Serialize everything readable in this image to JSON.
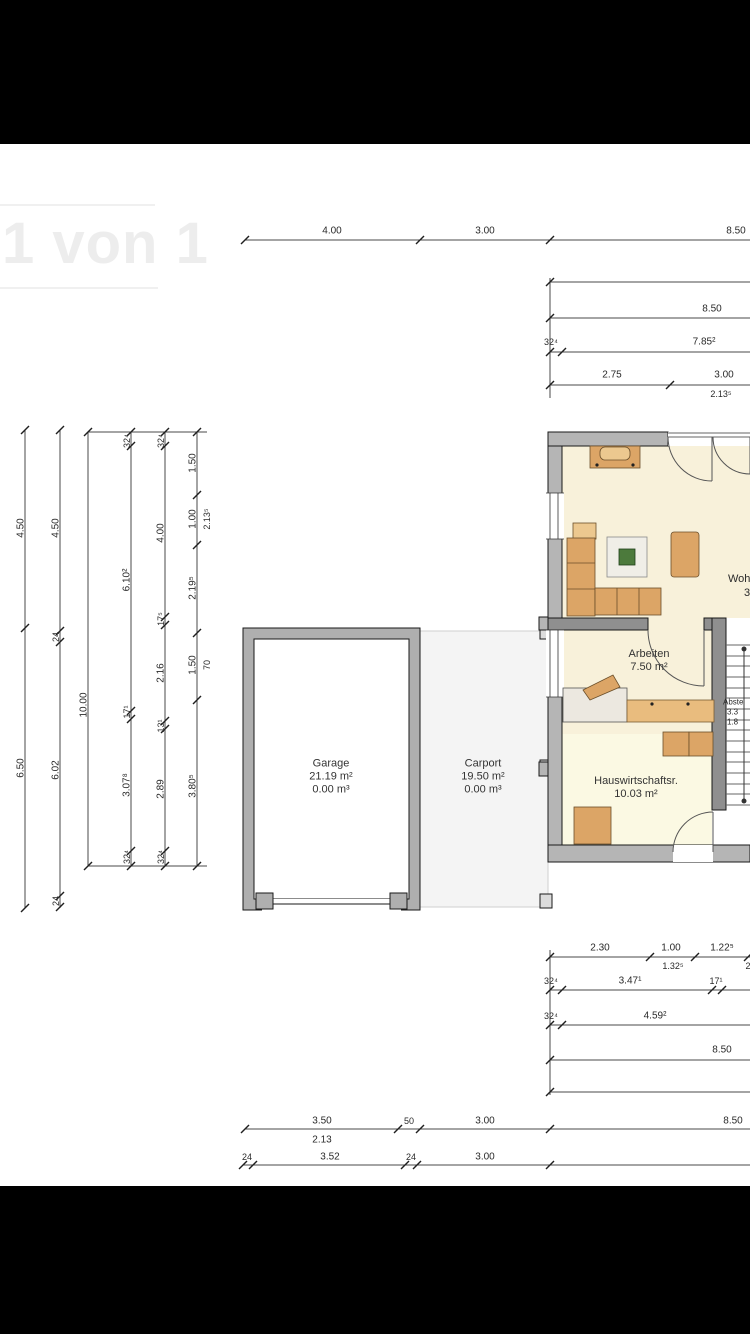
{
  "viewer": {
    "watermark": "1 von 1"
  },
  "colors": {
    "wall": "#B5B5B5",
    "innerwall": "#8F8F8F",
    "cream": "#F8F1DA",
    "pale": "#FBF9E3",
    "tan": "#DCA566",
    "tanlight": "#ECC88F",
    "counter": "#E9BC7E",
    "carport": "#F4F4F4",
    "dimline": "#4a4a4a",
    "dimtext": "#2a2a2a",
    "plant": "#4C7A3C"
  },
  "rooms": [
    {
      "name": "garage",
      "x": 331,
      "y": 777,
      "lines": [
        "Garage",
        "21.19 m²",
        "0.00 m³"
      ]
    },
    {
      "name": "carport",
      "x": 483,
      "y": 777,
      "lines": [
        "Carport",
        "19.50 m²",
        "0.00 m³"
      ]
    },
    {
      "name": "arbeiten",
      "x": 649,
      "y": 661,
      "lines": [
        "Arbeiten",
        "7.50 m²"
      ]
    },
    {
      "name": "hauswirtschaftsraum",
      "x": 636,
      "y": 788,
      "lines": [
        "Hauswirtschaftsr.",
        "10.03 m²"
      ]
    }
  ],
  "labels": [
    {
      "t": "4.00",
      "x": 332,
      "y": 231
    },
    {
      "t": "3.00",
      "x": 485,
      "y": 231
    },
    {
      "t": "8.50",
      "x": 736,
      "y": 231
    },
    {
      "t": "8.50",
      "x": 712,
      "y": 309
    },
    {
      "t": "32⁴",
      "x": 551,
      "y": 342,
      "s": 9
    },
    {
      "t": "7.85²",
      "x": 704,
      "y": 342
    },
    {
      "t": "2.75",
      "x": 612,
      "y": 375
    },
    {
      "t": "3.00",
      "x": 724,
      "y": 375
    },
    {
      "t": "2.13⁵",
      "x": 721,
      "y": 394,
      "s": 9
    },
    {
      "t": "4.50",
      "x": 21,
      "y": 528,
      "r": -90
    },
    {
      "t": "6.50",
      "x": 21,
      "y": 768,
      "r": -90
    },
    {
      "t": "4.50",
      "x": 56,
      "y": 528,
      "r": -90
    },
    {
      "t": "24",
      "x": 56,
      "y": 637,
      "r": -90,
      "s": 9
    },
    {
      "t": "6.02",
      "x": 56,
      "y": 770,
      "r": -90
    },
    {
      "t": "24",
      "x": 56,
      "y": 901,
      "r": -90,
      "s": 9
    },
    {
      "t": "10.00",
      "x": 84,
      "y": 705,
      "r": -90
    },
    {
      "t": "32⁴",
      "x": 127,
      "y": 441,
      "r": -90,
      "s": 9
    },
    {
      "t": "6.10²",
      "x": 127,
      "y": 580,
      "r": -90
    },
    {
      "t": "17¹",
      "x": 127,
      "y": 712,
      "r": -90,
      "s": 9
    },
    {
      "t": "3.07⁸",
      "x": 127,
      "y": 785,
      "r": -90
    },
    {
      "t": "32⁴",
      "x": 127,
      "y": 857,
      "r": -90,
      "s": 9
    },
    {
      "t": "32⁴",
      "x": 161,
      "y": 441,
      "r": -90,
      "s": 9
    },
    {
      "t": "4.00",
      "x": 161,
      "y": 533,
      "r": -90
    },
    {
      "t": "17⁵",
      "x": 161,
      "y": 619,
      "r": -90,
      "s": 9
    },
    {
      "t": "2.16",
      "x": 161,
      "y": 673,
      "r": -90
    },
    {
      "t": "13¹",
      "x": 161,
      "y": 726,
      "r": -90,
      "s": 9
    },
    {
      "t": "2.89",
      "x": 161,
      "y": 789,
      "r": -90
    },
    {
      "t": "32⁴",
      "x": 161,
      "y": 857,
      "r": -90,
      "s": 9
    },
    {
      "t": "1.50",
      "x": 193,
      "y": 463,
      "r": -90
    },
    {
      "t": "1.00",
      "x": 193,
      "y": 519,
      "r": -90
    },
    {
      "t": "2.19⁵",
      "x": 193,
      "y": 588,
      "r": -90
    },
    {
      "t": "1.50",
      "x": 193,
      "y": 665,
      "r": -90
    },
    {
      "t": "3.80⁵",
      "x": 193,
      "y": 786,
      "r": -90
    },
    {
      "t": "2.13⁵",
      "x": 207,
      "y": 519,
      "r": -90,
      "s": 9
    },
    {
      "t": "70",
      "x": 207,
      "y": 665,
      "r": -90,
      "s": 9
    },
    {
      "t": "Woh",
      "x": 728,
      "y": 579,
      "s": 11,
      "a": "l",
      "n": "room-label-wohnen-cut"
    },
    {
      "t": "3",
      "x": 744,
      "y": 593,
      "s": 11,
      "a": "l",
      "n": "room-label-wohnen-cut"
    },
    {
      "t": "Abste",
      "x": 723,
      "y": 702,
      "s": 8,
      "a": "l",
      "n": "room-label-abstellraum-cut"
    },
    {
      "t": "3.3",
      "x": 727,
      "y": 712,
      "s": 8,
      "a": "l",
      "n": "room-label-abstellraum-cut"
    },
    {
      "t": "1.8",
      "x": 727,
      "y": 722,
      "s": 8,
      "a": "l",
      "n": "room-label-abstellraum-cut"
    },
    {
      "t": "2.30",
      "x": 600,
      "y": 948
    },
    {
      "t": "1.00",
      "x": 671,
      "y": 948
    },
    {
      "t": "1.22⁵",
      "x": 722,
      "y": 948
    },
    {
      "t": "1.32⁵",
      "x": 673,
      "y": 966,
      "s": 9
    },
    {
      "t": "2",
      "x": 748,
      "y": 966,
      "s": 9
    },
    {
      "t": "32⁴",
      "x": 551,
      "y": 981,
      "s": 9
    },
    {
      "t": "3.47¹",
      "x": 630,
      "y": 981
    },
    {
      "t": "17¹",
      "x": 716,
      "y": 981,
      "s": 9
    },
    {
      "t": "32⁴",
      "x": 551,
      "y": 1016,
      "s": 9
    },
    {
      "t": "4.59²",
      "x": 655,
      "y": 1016
    },
    {
      "t": "8.50",
      "x": 722,
      "y": 1050
    },
    {
      "t": "3.50",
      "x": 322,
      "y": 1121
    },
    {
      "t": "50",
      "x": 409,
      "y": 1121,
      "s": 9
    },
    {
      "t": "3.00",
      "x": 485,
      "y": 1121
    },
    {
      "t": "8.50",
      "x": 733,
      "y": 1121
    },
    {
      "t": "2.13",
      "x": 322,
      "y": 1140
    },
    {
      "t": "24",
      "x": 247,
      "y": 1157,
      "s": 9
    },
    {
      "t": "3.52",
      "x": 330,
      "y": 1157
    },
    {
      "t": "24",
      "x": 411,
      "y": 1157,
      "s": 9
    },
    {
      "t": "3.00",
      "x": 485,
      "y": 1157
    }
  ]
}
